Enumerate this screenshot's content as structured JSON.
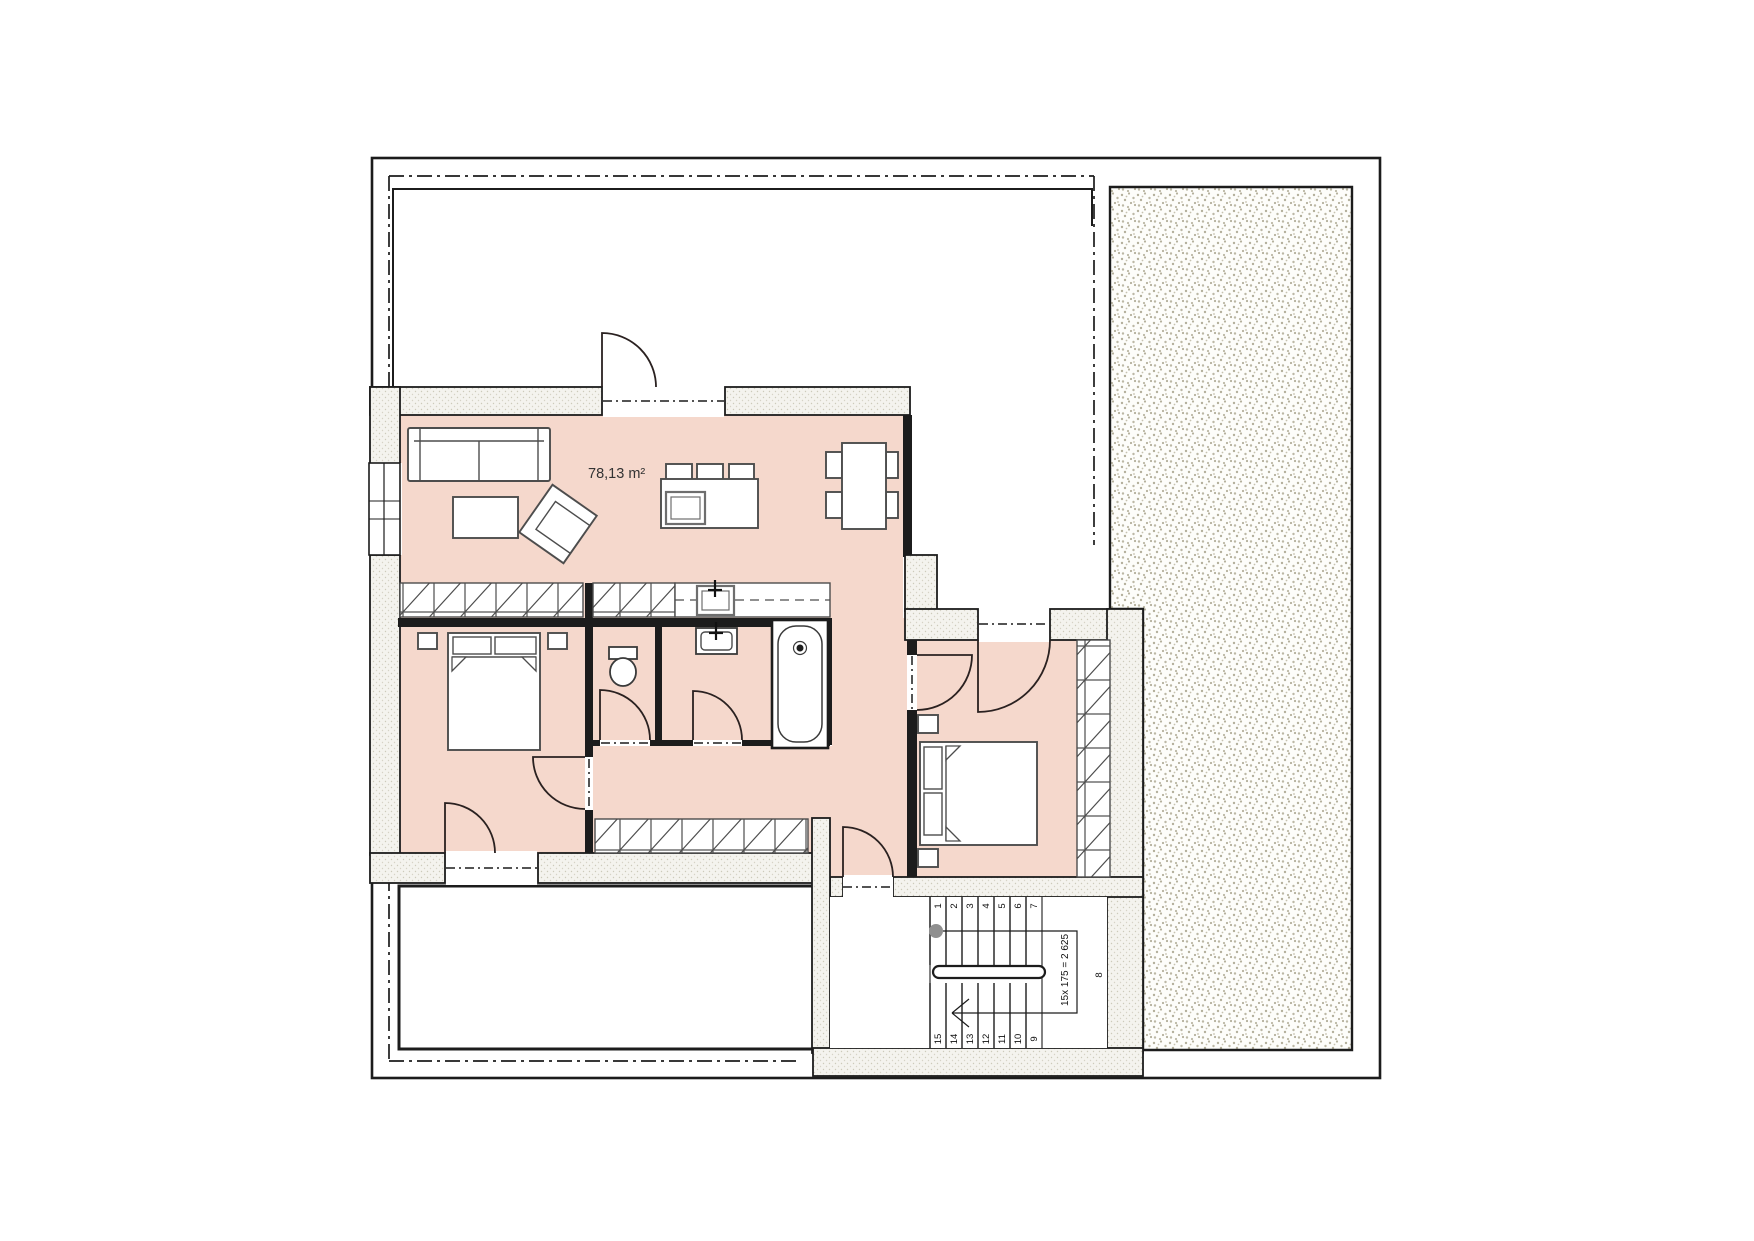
{
  "labels": {
    "area": "78,13 m²"
  },
  "stairs": {
    "formula": "15x 175 = 2 625",
    "upper": [
      "1",
      "2",
      "3",
      "4",
      "5",
      "6",
      "7"
    ],
    "lower": [
      "15",
      "14",
      "13",
      "12",
      "11",
      "10",
      "9"
    ],
    "landing": "8"
  },
  "colors": {
    "room_fill": "#f5d8cc",
    "line": "#1c1c1c",
    "wall_fill": "#f4f3ee",
    "wall_dot": "#cdcaba",
    "terrace_dot": "#b4b09c",
    "furniture_stroke": "#4d4d4d",
    "walkline_dot": "#8f8f8f"
  }
}
